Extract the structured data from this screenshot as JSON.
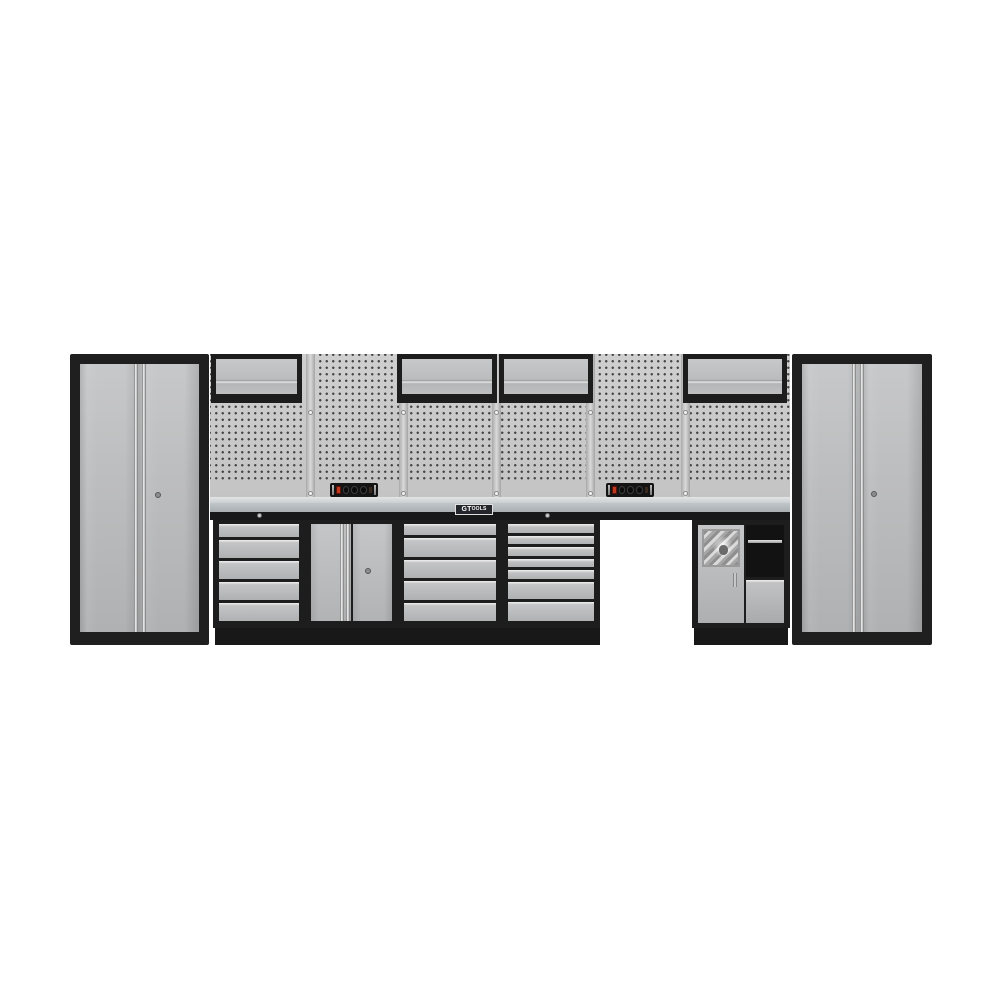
{
  "brand": {
    "logo_prefix": "GT",
    "logo_suffix": "OOLS"
  },
  "colors": {
    "background": "#ffffff",
    "frame_black": "#1f1f1f",
    "door_grey": "#bcbec0",
    "pegboard_grey": "#c8c8c8",
    "bench_steel": "#c0c5c8",
    "plinth_black": "#181818",
    "switch_red": "#c0391f"
  },
  "assembly": {
    "description_units": {
      "left_tall_locker": {
        "doors": 2,
        "keyhole": true
      },
      "wall_cabinets": {
        "count": 4,
        "door_type": "lift-up flap"
      },
      "pegboard_panels": {
        "count": 6,
        "rails": 5,
        "screws_per_rail": 2
      },
      "power_strips": {
        "count": 2,
        "sockets_per_strip": 3,
        "has_red_switch": true
      },
      "workbench": {
        "material": "stainless steel",
        "brand_badge": true
      },
      "drawer_unit_a": {
        "drawer_weights": [
          0.75,
          1,
          1,
          1,
          1
        ]
      },
      "floor_door_cabinet": {
        "doors": 2,
        "keyhole": true
      },
      "drawer_unit_b": {
        "drawer_weights": [
          0.7,
          1.15,
          1.15,
          1.15,
          1.15
        ]
      },
      "drawer_unit_c": {
        "drawer_weights": [
          0.8,
          0.8,
          0.8,
          0.8,
          0.8,
          1.6,
          1.8
        ]
      },
      "open_knee_space": {
        "present": true
      },
      "combo_cabinet": {
        "features": [
          "dispenser-door",
          "open-shelf",
          "drawer"
        ]
      },
      "right_tall_locker": {
        "doors": 2,
        "keyhole": true
      }
    }
  }
}
